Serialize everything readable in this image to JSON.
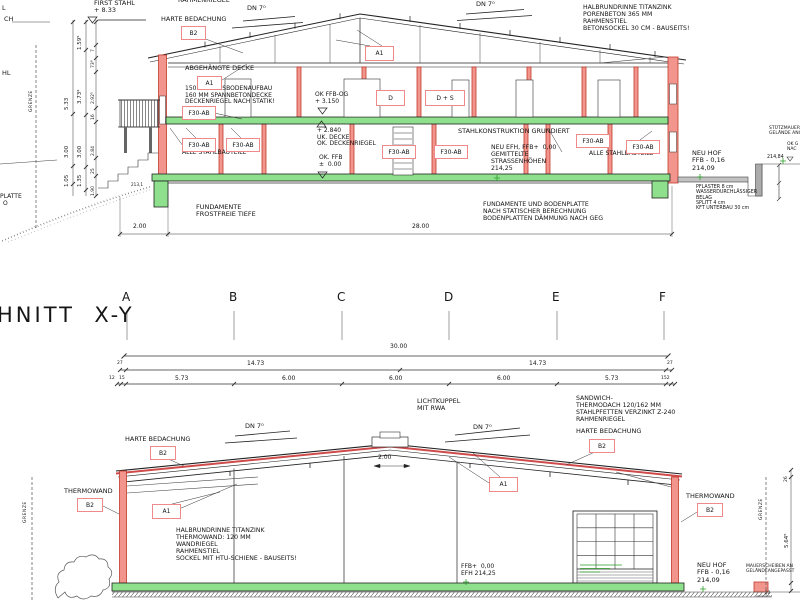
{
  "title": "HNITT  X-Y",
  "colors": {
    "line": "#222222",
    "column_red_fill": "#f2958d",
    "column_red_stroke": "#c0392b",
    "roof_red": "#cf4b4b",
    "slab_green": "#8ee08c",
    "marker_green": "#2aa02a",
    "label_box_border": "#f08a8a"
  },
  "red_boxes": [
    {
      "n": "tag-b2-roof-top",
      "t": "B2",
      "x": 181,
      "y": 26,
      "w": 23,
      "h": 12
    },
    {
      "n": "tag-a1-ceiling",
      "t": "A1",
      "x": 197,
      "y": 76,
      "w": 23,
      "h": 12
    },
    {
      "n": "tag-a1-roof-top",
      "t": "A1",
      "x": 365,
      "y": 46,
      "w": 27,
      "h": 13
    },
    {
      "n": "tag-f30-ab-1",
      "t": "F30-AB",
      "x": 182,
      "y": 106,
      "w": 32,
      "h": 12
    },
    {
      "n": "tag-door-d",
      "t": "D",
      "x": 376,
      "y": 90,
      "w": 27,
      "h": 14
    },
    {
      "n": "tag-door-d-s",
      "t": "D + S",
      "x": 425,
      "y": 90,
      "w": 38,
      "h": 14
    },
    {
      "n": "tag-f30-ab-2",
      "t": "F30-AB",
      "x": 182,
      "y": 138,
      "w": 32,
      "h": 12
    },
    {
      "n": "tag-f30-ab-3",
      "t": "F30-AB",
      "x": 226,
      "y": 138,
      "w": 32,
      "h": 12
    },
    {
      "n": "tag-f30-ab-4",
      "t": "F30-AB",
      "x": 382,
      "y": 145,
      "w": 32,
      "h": 12
    },
    {
      "n": "tag-f30-ab-5",
      "t": "F30-AB",
      "x": 434,
      "y": 145,
      "w": 32,
      "h": 12
    },
    {
      "n": "tag-f30-ab-6",
      "t": "F30-AB",
      "x": 576,
      "y": 134,
      "w": 32,
      "h": 12
    },
    {
      "n": "tag-f30-ab-7",
      "t": "F30-AB",
      "x": 626,
      "y": 140,
      "w": 32,
      "h": 12
    },
    {
      "n": "tag-b2-harte-bottom-left",
      "t": "B2",
      "x": 150,
      "y": 446,
      "w": 24,
      "h": 12
    },
    {
      "n": "tag-b2-harte-bottom-right",
      "t": "B2",
      "x": 589,
      "y": 439,
      "w": 24,
      "h": 12
    },
    {
      "n": "tag-b2-thermowand-left",
      "t": "B2",
      "x": 77,
      "y": 498,
      "w": 24,
      "h": 12
    },
    {
      "n": "tag-b2-thermowand-right",
      "t": "B2",
      "x": 697,
      "y": 503,
      "w": 24,
      "h": 12
    },
    {
      "n": "tag-a1-bottom-left",
      "t": "A1",
      "x": 152,
      "y": 504,
      "w": 27,
      "h": 13
    },
    {
      "n": "tag-a1-bottom-right",
      "t": "A1",
      "x": 489,
      "y": 477,
      "w": 27,
      "h": 13
    }
  ],
  "labels": [
    {
      "n": "first-stahl-note",
      "ls": [
        "FIRST STAHL",
        "+ 8.33"
      ],
      "x": 94,
      "y": 0,
      "fs": 6.5
    },
    {
      "n": "harte-bedachung-top",
      "t": "HARTE BEDACHUNG",
      "x": 161,
      "y": 16,
      "fs": 6.5
    },
    {
      "n": "rahmenriegel-clipped",
      "t": "RAHMENRIEGEL",
      "x": 178,
      "y": -3,
      "fs": 6.5
    },
    {
      "n": "dn7-top-left",
      "t": "DN 7⁰",
      "x": 247,
      "y": 5,
      "fs": 6.5
    },
    {
      "n": "dn7-top-right",
      "t": "DN 7⁰",
      "x": 476,
      "y": 1,
      "fs": 6.5
    },
    {
      "n": "halbrundrinne-top-note",
      "ls": [
        "HALBRUNDRINNE TITANZINK",
        "PORENBETON 365 MM",
        "RAHMENSTIEL",
        "BETONSOCKEL 30 CM - BAUSEITS!"
      ],
      "x": 583,
      "y": 5,
      "fs": 6.2
    },
    {
      "n": "abgehaengte-decke",
      "t": "ABGEHÄNGTE DECKE",
      "x": 185,
      "y": 65,
      "fs": 6.5
    },
    {
      "n": "fussboden-note",
      "ls": [
        "150 MM FUSSBODENAUFBAU",
        "160 MM SPANNBETONDECKE",
        "DECKENRIEGEL NACH STATIK!"
      ],
      "x": 185,
      "y": 86,
      "fs": 6
    },
    {
      "n": "ok-ffb-og-note",
      "ls": [
        "OK FFB-OG",
        "+ 3.150"
      ],
      "x": 315,
      "y": 92,
      "fs": 6
    },
    {
      "n": "uk-decke-note",
      "ls": [
        "+ 2.840",
        "UK. DECKE",
        "OK. DECKENRIEGEL"
      ],
      "x": 317,
      "y": 128,
      "fs": 6
    },
    {
      "n": "ok-ffb-note",
      "ls": [
        "OK. FFB",
        "±  0.00"
      ],
      "x": 319,
      "y": 155,
      "fs": 6
    },
    {
      "n": "alle-stahlbauteile-left",
      "t": "ALLE STAHLBAUTEILE",
      "x": 182,
      "y": 150,
      "fs": 6
    },
    {
      "n": "stahlkonstruktion-note",
      "t": "STAHLKONSTRUKTION GRUNDIERT",
      "x": 458,
      "y": 128,
      "fs": 6.5
    },
    {
      "n": "neu-efh-note",
      "ls": [
        "NEU EFH, FFB+  0,00",
        "GEMITTELTE",
        "STRASSENHÖHEN",
        "214,25"
      ],
      "x": 491,
      "y": 145,
      "fs": 6.2
    },
    {
      "n": "alle-stahlbauteile-right",
      "t": "ALLE STAHLBAUTEILE",
      "x": 589,
      "y": 151,
      "fs": 6
    },
    {
      "n": "fundamente-left-note",
      "ls": [
        "FUNDAMENTE",
        "FROSTFREIE TIEFE"
      ],
      "x": 196,
      "y": 204,
      "fs": 6.5
    },
    {
      "n": "fundamente-right-note",
      "ls": [
        "FUNDAMENTE UND BODENPLATTE",
        "NACH STATISCHER BERECHNUNG",
        "BODENPLATTEN DÄMMUNG NACH GEG"
      ],
      "x": 483,
      "y": 202,
      "fs": 6.2
    },
    {
      "n": "neu-hof-top-note",
      "ls": [
        "NEU HOF",
        "FFB - 0,16",
        "214,09"
      ],
      "x": 692,
      "y": 150,
      "fs": 6.5
    },
    {
      "n": "pflaster-note",
      "ls": [
        "PFLASTER 8 cm",
        "WASSERDURCHLÄSSIGER",
        "BELAG",
        "SPLITT 4 cm",
        "KFT UNTERBAU 30 cm"
      ],
      "x": 696,
      "y": 185,
      "fs": 4.8
    },
    {
      "n": "stuetzmauer-note",
      "ls": [
        "STÜTZMAUER",
        "GELÄNDE ANG"
      ],
      "x": 769,
      "y": 126,
      "fs": 4.5
    },
    {
      "n": "ok-gelaende-note",
      "ls": [
        "OK G",
        "NAC"
      ],
      "x": 787,
      "y": 142,
      "fs": 4.5
    },
    {
      "n": "elev-214-84",
      "t": "214,84",
      "x": 767,
      "y": 155,
      "fs": 4.8
    },
    {
      "n": "dim-2-00-top",
      "t": "2.00",
      "x": 133,
      "y": 224,
      "fs": 6
    },
    {
      "n": "dim-28-00-top",
      "t": "28.00",
      "x": 412,
      "y": 224,
      "fs": 6
    },
    {
      "n": "elev-213-1",
      "t": "213,1",
      "x": 131,
      "y": 183,
      "fs": 4.2
    },
    {
      "n": "edge-text-l",
      "t": "L",
      "x": 2,
      "y": 5,
      "fs": 6.5
    },
    {
      "n": "edge-text-ch",
      "t": "CH",
      "x": 4,
      "y": 16,
      "fs": 6.5
    },
    {
      "n": "edge-text-hl",
      "t": "HL",
      "x": 2,
      "y": 70,
      "fs": 6.5
    },
    {
      "n": "edge-text-platte",
      "t": "PLATTE",
      "x": 0,
      "y": 194,
      "fs": 6
    },
    {
      "n": "edge-text-o",
      "t": "O",
      "x": 3,
      "y": 201,
      "fs": 6
    },
    {
      "n": "grenze-top-left",
      "t": "GRENZE",
      "x": 29,
      "y": 112,
      "fs": 4.5,
      "rot": -90,
      "sp": 0.5
    },
    {
      "n": "dim-5-33",
      "t": "5.33",
      "x": 64,
      "y": 110,
      "fs": 5.5,
      "rot": -90
    },
    {
      "n": "dim-3-00-a",
      "t": "3.00",
      "x": 64,
      "y": 158,
      "fs": 5.5,
      "rot": -90
    },
    {
      "n": "dim-1-05",
      "t": "1.05",
      "x": 64,
      "y": 187,
      "fs": 5.5,
      "rot": -90
    },
    {
      "n": "dim-1-59",
      "t": "1.59⁵",
      "x": 77,
      "y": 50,
      "fs": 5.5,
      "rot": -90
    },
    {
      "n": "dim-3-73",
      "t": "3.73⁴",
      "x": 77,
      "y": 104,
      "fs": 5.5,
      "rot": -90
    },
    {
      "n": "dim-3-00-b",
      "t": "3.00",
      "x": 77,
      "y": 158,
      "fs": 5.5,
      "rot": -90
    },
    {
      "n": "dim-1-35",
      "t": "1.35",
      "x": 77,
      "y": 187,
      "fs": 5.5,
      "rot": -90
    },
    {
      "n": "dim-7",
      "t": "7",
      "x": 91,
      "y": 52,
      "fs": 4.5,
      "rot": -90
    },
    {
      "n": "dim-73-9",
      "t": "73⁹",
      "x": 91,
      "y": 68,
      "fs": 4.5,
      "rot": -90
    },
    {
      "n": "dim-2-92",
      "t": "2.92⁵",
      "x": 91,
      "y": 104,
      "fs": 4.5,
      "rot": -90
    },
    {
      "n": "dim-16",
      "t": "16",
      "x": 91,
      "y": 120,
      "fs": 4.5,
      "rot": -90
    },
    {
      "n": "dim-2-84",
      "t": "2.84",
      "x": 91,
      "y": 156,
      "fs": 4.5,
      "rot": -90
    },
    {
      "n": "dim-25",
      "t": "25",
      "x": 91,
      "y": 174,
      "fs": 4.5,
      "rot": -90
    },
    {
      "n": "dim-1-90",
      "t": "1.90",
      "x": 91,
      "y": 196,
      "fs": 4.5,
      "rot": -90
    },
    {
      "n": "grid-letter-a",
      "t": "A",
      "x": 122,
      "y": 291,
      "fs": 12
    },
    {
      "n": "grid-letter-b",
      "t": "B",
      "x": 229,
      "y": 291,
      "fs": 12
    },
    {
      "n": "grid-letter-c",
      "t": "C",
      "x": 337,
      "y": 291,
      "fs": 12
    },
    {
      "n": "grid-letter-d",
      "t": "D",
      "x": 444,
      "y": 291,
      "fs": 12
    },
    {
      "n": "grid-letter-e",
      "t": "E",
      "x": 552,
      "y": 291,
      "fs": 12
    },
    {
      "n": "grid-letter-f",
      "t": "F",
      "x": 659,
      "y": 291,
      "fs": 12
    },
    {
      "n": "dim-30-00",
      "t": "30.00",
      "x": 390,
      "y": 344,
      "fs": 6
    },
    {
      "n": "dim-27-left",
      "t": "27",
      "x": 117,
      "y": 361,
      "fs": 4.5
    },
    {
      "n": "dim-14-73-left",
      "t": "14.73",
      "x": 247,
      "y": 361,
      "fs": 6
    },
    {
      "n": "dim-14-73-right",
      "t": "14.73",
      "x": 529,
      "y": 361,
      "fs": 6
    },
    {
      "n": "dim-27-right",
      "t": "27",
      "x": 667,
      "y": 361,
      "fs": 4.5
    },
    {
      "n": "dim-12",
      "t": "12",
      "x": 109,
      "y": 376,
      "fs": 4.5
    },
    {
      "n": "dim-15",
      "t": "15",
      "x": 119,
      "y": 376,
      "fs": 4.5
    },
    {
      "n": "dim-5-73-left",
      "t": "5.73",
      "x": 175,
      "y": 376,
      "fs": 6
    },
    {
      "n": "dim-6-00-a",
      "t": "6.00",
      "x": 282,
      "y": 376,
      "fs": 6
    },
    {
      "n": "dim-6-00-b",
      "t": "6.00",
      "x": 389,
      "y": 376,
      "fs": 6
    },
    {
      "n": "dim-6-00-c",
      "t": "6.00",
      "x": 497,
      "y": 376,
      "fs": 6
    },
    {
      "n": "dim-5-73-right",
      "t": "5.73",
      "x": 605,
      "y": 376,
      "fs": 6
    },
    {
      "n": "dim-152",
      "t": "152",
      "x": 661,
      "y": 376,
      "fs": 4.5
    },
    {
      "n": "lichtkuppel-note",
      "ls": [
        "LICHTKUPPEL",
        "MIT RWA"
      ],
      "x": 417,
      "y": 398,
      "fs": 6.5
    },
    {
      "n": "sandwich-note",
      "ls": [
        "SANDWICH-",
        "THERMODACH 120/162 MM",
        "STAHLPFETTEN VERZINKT Z-240",
        "RAHMENRIEGEL"
      ],
      "x": 576,
      "y": 396,
      "fs": 6.2
    },
    {
      "n": "harte-bedachung-bottom-right",
      "t": "HARTE BEDACHUNG",
      "x": 576,
      "y": 428,
      "fs": 6.5
    },
    {
      "n": "dn7-bottom-left",
      "t": "DN 7⁰",
      "x": 245,
      "y": 423,
      "fs": 6.5
    },
    {
      "n": "dn7-bottom-right",
      "t": "DN 7⁰",
      "x": 473,
      "y": 424,
      "fs": 6.5
    },
    {
      "n": "harte-bedachung-bottom-left",
      "t": "HARTE BEDACHUNG",
      "x": 125,
      "y": 436,
      "fs": 6.5
    },
    {
      "n": "thermowand-left",
      "t": "THERMOWAND",
      "x": 64,
      "y": 488,
      "fs": 6.5
    },
    {
      "n": "dim-2-00-bottom",
      "t": "2.00",
      "x": 378,
      "y": 455,
      "fs": 6
    },
    {
      "n": "halbrundrinne-bottom-note",
      "ls": [
        "HALBRUNDRINNE TITANZINK",
        "THERMOWAND: 120 MM",
        "WANDRIEGEL",
        "RAHMENSTIEL",
        "SOCKEL MIT HTU-SCHIENE - BAUSEITS!"
      ],
      "x": 176,
      "y": 528,
      "fs": 6.2
    },
    {
      "n": "ffb-efh-note",
      "ls": [
        "FFB+  0,00",
        "EFH 214,25"
      ],
      "x": 461,
      "y": 564,
      "fs": 6
    },
    {
      "n": "thermowand-right",
      "t": "THERMOWAND",
      "x": 686,
      "y": 493,
      "fs": 6.5
    },
    {
      "n": "neu-hof-bottom-note",
      "ls": [
        "NEU HOF",
        "FFB - 0,16",
        "214,09"
      ],
      "x": 697,
      "y": 562,
      "fs": 6.5
    },
    {
      "n": "mauerscheiben-note",
      "ls": [
        "MAUERSCHEIBEN AN",
        "GELÄNDEANGEPASST"
      ],
      "x": 746,
      "y": 564,
      "fs": 4.5
    },
    {
      "n": "grenze-bottom-left",
      "t": "GRENZE",
      "x": 23,
      "y": 523,
      "fs": 4.5,
      "rot": -90,
      "sp": 0.5
    },
    {
      "n": "grenze-bottom-right",
      "t": "GRENZE",
      "x": 759,
      "y": 520,
      "fs": 4.5,
      "rot": -90,
      "sp": 0.5
    },
    {
      "n": "dim-26",
      "t": "26",
      "x": 784,
      "y": 482,
      "fs": 4.5,
      "rot": -90
    },
    {
      "n": "dim-5-64",
      "t": "5.64⁵",
      "x": 784,
      "y": 548,
      "fs": 5.5,
      "rot": -90
    },
    {
      "n": "dim-20-right",
      "t": "20",
      "x": 765,
      "y": 591,
      "fs": 4
    }
  ]
}
